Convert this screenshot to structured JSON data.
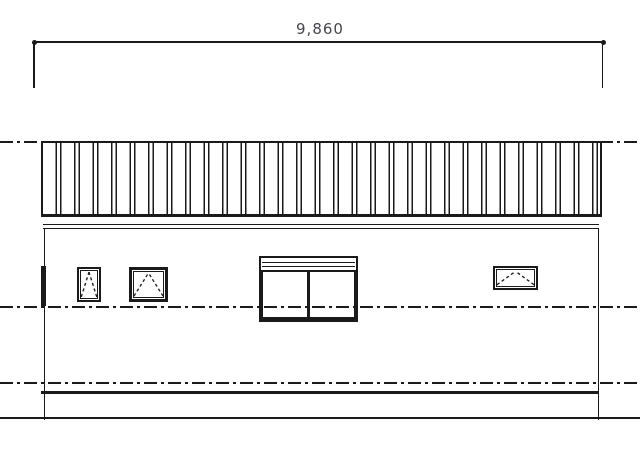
{
  "drawing": {
    "type": "architectural-elevation",
    "dimension": {
      "label": "9,860"
    },
    "colors": {
      "line": "#1a1a1a",
      "dimension_text": "#45464e",
      "background": "#ffffff"
    },
    "elements": {
      "roof": "standing-seam-roof-band",
      "reference_lines": [
        "roof-level-centerline",
        "sill-level-centerline",
        "base-level-centerline"
      ],
      "windows": [
        "small-awning-window",
        "medium-awning-window",
        "sliding-window-with-shutter-box",
        "wide-awning-window"
      ],
      "ground": "ground-line",
      "floor": "floor-slab-line"
    }
  }
}
